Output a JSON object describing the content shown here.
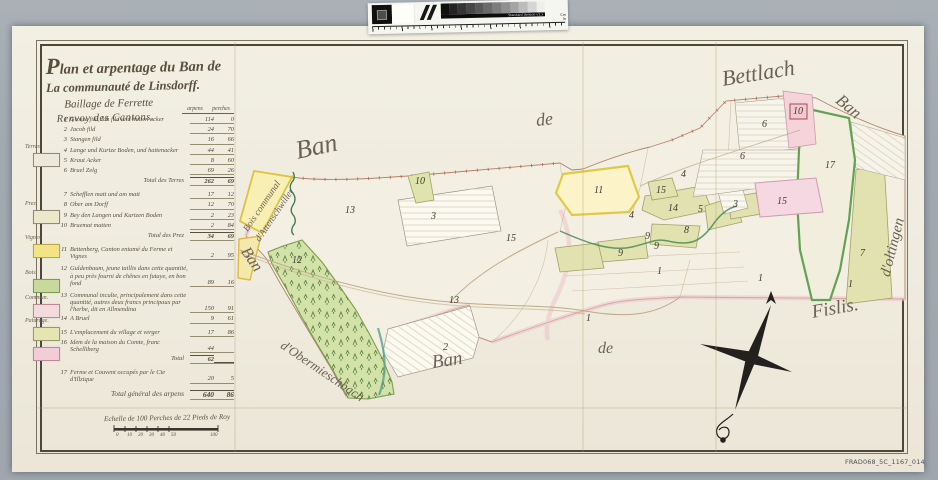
{
  "scan": {
    "reference": "FRAD068_5C_1167_014",
    "calibration_bar": {
      "version_text": "Standard Version v1.x",
      "cm_label": "Cm",
      "in_label": "In",
      "gray_steps": [
        "#101010",
        "#232323",
        "#353535",
        "#474747",
        "#585858",
        "#6a6a6a",
        "#7d7d7d",
        "#909090",
        "#a4a4a4",
        "#bcbcbc",
        "#d6d6d6",
        "#efefec"
      ]
    }
  },
  "title": {
    "line1": "Plan et arpentage du Ban de",
    "line2": "La communauté de Linsdorff.",
    "line3": "Baillage de Ferrette",
    "line4": "Renvoy des Cantons.",
    "col_arpens": "arpens",
    "col_perches": "perches"
  },
  "legend": {
    "swatches": [
      {
        "label": "Terres.",
        "color": "#ece9da",
        "border": "#918a7a",
        "x": 33,
        "y": 153
      },
      {
        "label": "Prez.",
        "color": "#e9e8c9",
        "border": "#918a7a",
        "x": 33,
        "y": 210
      },
      {
        "label": "Vignes.",
        "color": "#f2e387",
        "border": "#b9a84a",
        "x": 33,
        "y": 244
      },
      {
        "label": "Bois.",
        "color": "#c8da9b",
        "border": "#7d9a53",
        "x": 33,
        "y": 279
      },
      {
        "label": "Commun.",
        "color": "#f3dadc",
        "border": "#b98a92",
        "x": 33,
        "y": 304
      },
      {
        "label": "Paturage.",
        "color": "#e5e5b2",
        "border": "#9a9a66",
        "x": 33,
        "y": 327
      },
      {
        "label": "",
        "color": "#f2ccd7",
        "border": "#bd8a9b",
        "x": 33,
        "y": 347
      }
    ],
    "rows": [
      {
        "no": "1",
        "label": "Grosse fild, loh fild und hutten acker",
        "arpens": "114",
        "perches": "0"
      },
      {
        "no": "2",
        "label": "Jacob fild",
        "arpens": "24",
        "perches": "70"
      },
      {
        "no": "3",
        "label": "Stangen fild",
        "arpens": "16",
        "perches": "66"
      },
      {
        "no": "4",
        "label": "Lange und Kurtze Boden, und hattenacker",
        "arpens": "44",
        "perches": "41"
      },
      {
        "no": "5",
        "label": "Kraut Acker",
        "arpens": "8",
        "perches": "60"
      },
      {
        "no": "6",
        "label": "Bruel Zelg",
        "arpens": "69",
        "perches": "26"
      },
      {
        "no": "",
        "label": "Total des Terres",
        "arpens": "262",
        "perches": "69",
        "type": "total"
      },
      {
        "no": "7",
        "label": "Schefflen matt und am matt",
        "arpens": "17",
        "perches": "12",
        "gap": true
      },
      {
        "no": "8",
        "label": "Ober am Dorff",
        "arpens": "12",
        "perches": "70"
      },
      {
        "no": "9",
        "label": "Bey den Langen und Kurtzen Boden",
        "arpens": "2",
        "perches": "23"
      },
      {
        "no": "10",
        "label": "Bruemat matten",
        "arpens": "2",
        "perches": "84"
      },
      {
        "no": "",
        "label": "Total des Prez",
        "arpens": "34",
        "perches": "69",
        "type": "total"
      },
      {
        "no": "11",
        "label": "Bettenberg, Canton entamé du Ferme et Vignes",
        "arpens": "2",
        "perches": "95",
        "gap": true
      },
      {
        "no": "12",
        "label": "Guldenbaum, jeune taillis dans cette quantité, à peu près fourni de chênes en futaye, en bon fond",
        "arpens": "89",
        "perches": "16",
        "gap": true
      },
      {
        "no": "13",
        "label": "Communal inculte, principalement dans cette quantité, autres deux francs principaux par l'herbe, dit en Allmendina",
        "arpens": "150",
        "perches": "91",
        "gap": true
      },
      {
        "no": "14",
        "label": "A Bruel",
        "arpens": "9",
        "perches": "61"
      },
      {
        "no": "15",
        "label": "L'emplacement du village et verger",
        "arpens": "17",
        "perches": "86",
        "gap": true
      },
      {
        "no": "16",
        "label": "Idem de la maison du Comte, franc Schelliberg",
        "arpens": "44",
        "perches": ""
      },
      {
        "no": "",
        "label": "Total",
        "arpens": "62",
        "perches": "",
        "type": "total"
      },
      {
        "no": "17",
        "label": "Ferme et Couvent occupés par le Cte d'Illzique",
        "arpens": "20",
        "perches": "5",
        "gap": true
      },
      {
        "no": "",
        "label": "Total général des arpens",
        "arpens": "640",
        "perches": "86",
        "type": "total",
        "grand": true
      }
    ]
  },
  "scale": {
    "caption": "Echelle de 100 Perches de 22 Pieds de Roy",
    "numbers": [
      {
        "t": "0",
        "x": 116
      },
      {
        "t": "10",
        "x": 127
      },
      {
        "t": "20",
        "x": 138
      },
      {
        "t": "30",
        "x": 149
      },
      {
        "t": "40",
        "x": 160
      },
      {
        "t": "50",
        "x": 171
      },
      {
        "t": "100",
        "x": 210
      }
    ]
  },
  "map": {
    "labels": [
      {
        "text": "Ban",
        "x": 296,
        "y": 136,
        "rot": -12,
        "size": 26
      },
      {
        "text": "de",
        "x": 536,
        "y": 110,
        "rot": -6,
        "size": 18
      },
      {
        "text": "Bettlach",
        "x": 722,
        "y": 66,
        "rot": -9,
        "size": 22
      },
      {
        "text": "Ban",
        "x": 838,
        "y": 88,
        "rot": 40,
        "size": 17
      },
      {
        "text": "d'oltingen",
        "x": 886,
        "y": 268,
        "rot": -76,
        "size": 15
      },
      {
        "text": "Fislis.",
        "x": 812,
        "y": 302,
        "rot": -10,
        "size": 19
      },
      {
        "text": "de",
        "x": 598,
        "y": 340,
        "rot": 0,
        "size": 16
      },
      {
        "text": "Ban",
        "x": 432,
        "y": 352,
        "rot": -8,
        "size": 19
      },
      {
        "text": "d'Obermieschbach",
        "x": 282,
        "y": 336,
        "rot": 34,
        "size": 13
      },
      {
        "text": "Ban",
        "x": 244,
        "y": 240,
        "rot": 56,
        "size": 16
      },
      {
        "text": "Bois communal",
        "x": 246,
        "y": 226,
        "rot": -56,
        "size": 9.5
      },
      {
        "text": "d'Attenschwiller",
        "x": 258,
        "y": 236,
        "rot": -56,
        "size": 9.5
      }
    ],
    "parcel_numbers": [
      {
        "n": "13",
        "x": 345,
        "y": 205
      },
      {
        "n": "10",
        "x": 415,
        "y": 176
      },
      {
        "n": "3",
        "x": 431,
        "y": 211
      },
      {
        "n": "12",
        "x": 292,
        "y": 255
      },
      {
        "n": "15",
        "x": 506,
        "y": 233
      },
      {
        "n": "13",
        "x": 449,
        "y": 295
      },
      {
        "n": "2",
        "x": 443,
        "y": 342
      },
      {
        "n": "1",
        "x": 586,
        "y": 313
      },
      {
        "n": "11",
        "x": 594,
        "y": 185
      },
      {
        "n": "4",
        "x": 629,
        "y": 210
      },
      {
        "n": "4",
        "x": 681,
        "y": 169
      },
      {
        "n": "15",
        "x": 656,
        "y": 185
      },
      {
        "n": "14",
        "x": 668,
        "y": 203
      },
      {
        "n": "5",
        "x": 698,
        "y": 204
      },
      {
        "n": "3",
        "x": 733,
        "y": 199
      },
      {
        "n": "8",
        "x": 684,
        "y": 225
      },
      {
        "n": "9",
        "x": 645,
        "y": 231
      },
      {
        "n": "9",
        "x": 654,
        "y": 241
      },
      {
        "n": "9",
        "x": 618,
        "y": 248
      },
      {
        "n": "1",
        "x": 657,
        "y": 266
      },
      {
        "n": "1",
        "x": 758,
        "y": 273
      },
      {
        "n": "6",
        "x": 762,
        "y": 119
      },
      {
        "n": "6",
        "x": 740,
        "y": 151
      },
      {
        "n": "17",
        "x": 825,
        "y": 160
      },
      {
        "n": "15",
        "x": 777,
        "y": 196
      },
      {
        "n": "10",
        "x": 793,
        "y": 106
      },
      {
        "n": "7",
        "x": 860,
        "y": 248
      },
      {
        "n": "1",
        "x": 848,
        "y": 279
      }
    ]
  },
  "colors": {
    "surround_gray": "#a5abb2",
    "paper": "#f0ecdf",
    "ink": "#57503f",
    "boundary": "#b3826a",
    "pink_edge": "#ecc2cb",
    "forest_green": "#cfe0a4",
    "vignes_yellow": "#fcf4c8",
    "khaki": "#e2e2b0",
    "pink_parcel": "#f5d8e2",
    "stream_green": "#3e7a4e",
    "road_tan": "#c2a887"
  }
}
